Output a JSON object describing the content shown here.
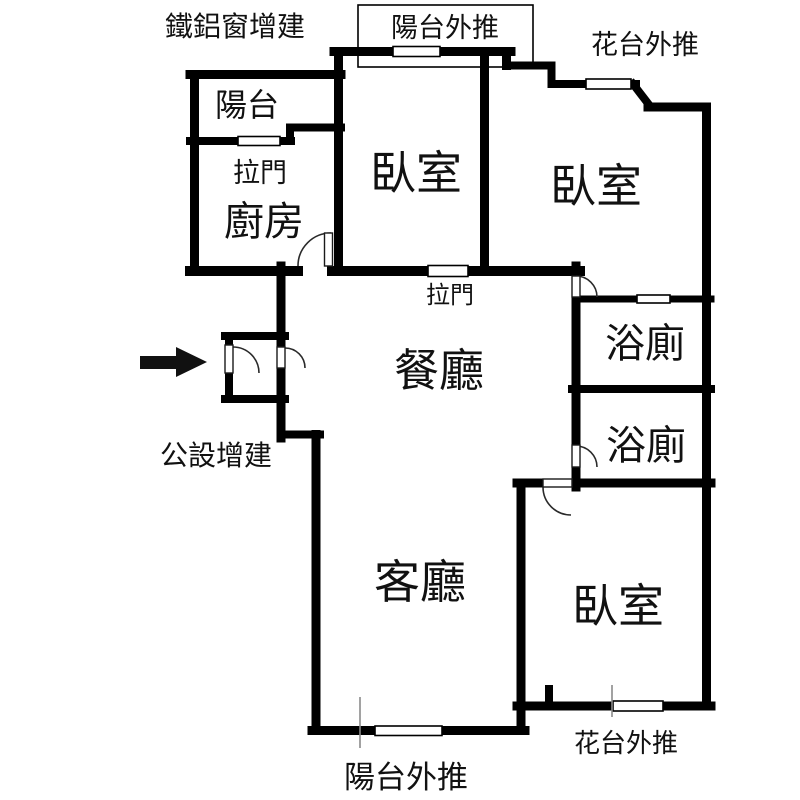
{
  "plan_type": "apartment-floor-plan",
  "rooms": {
    "balcony": "陽台",
    "kitchen": "廚房",
    "bedroom1": "臥室",
    "bedroom2": "臥室",
    "bedroom3": "臥室",
    "bath1": "浴廁",
    "bath2": "浴廁",
    "dining": "餐廳",
    "living": "客廳"
  },
  "annotations": {
    "iron_window_addition": "鐵鋁窗增建",
    "balcony_pushout_top": "陽台外推",
    "flower_pushout_top": "花台外推",
    "sliding_door_kitchen": "拉門",
    "sliding_door_dining": "拉門",
    "common_facility_addition": "公設增建",
    "flower_pushout_bottom": "花台外推",
    "balcony_pushout_bottom": "陽台外推"
  },
  "colors": {
    "wall": "#000000",
    "background": "#ffffff",
    "text": "#111111",
    "arrow": "#111111",
    "tick": "#8a8a8a"
  }
}
